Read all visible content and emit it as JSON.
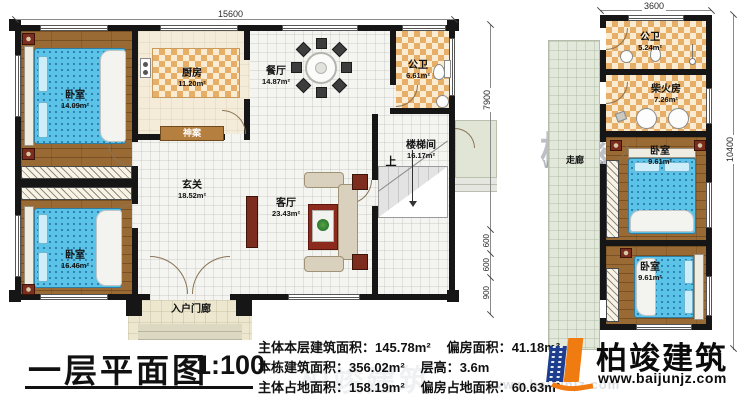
{
  "title": {
    "text": "一层平面图",
    "scale": "1:100"
  },
  "stats": [
    {
      "label1": "主体本层建筑面积：",
      "value1": "145.78m²",
      "label2": "偏房面积：",
      "value2": "41.18m²"
    },
    {
      "label1": "本栋建筑面积：",
      "value1": "356.02m²",
      "label2": "层高：",
      "value2": "3.6m"
    },
    {
      "label1": "主体占地面积：",
      "value1": "158.19m²",
      "label2": "偏房占地面积：",
      "value2": "60.63m²"
    }
  ],
  "logo": {
    "name": "柏竣建筑",
    "url": "www.baijunjz.com"
  },
  "watermark": {
    "name": "柏竣建筑",
    "url": "www.baijunjz.com"
  },
  "main_plan": {
    "dim_top": "15600",
    "dim_right": "7900",
    "dims_right_lower": [
      "600",
      "600",
      "900"
    ],
    "stairs_up": "上",
    "rooms": {
      "bedroom1": {
        "name": "卧室",
        "area": "14.09m²"
      },
      "bedroom2": {
        "name": "卧室",
        "area": "16.46m²"
      },
      "kitchen": {
        "name": "厨房",
        "area": "11.20m²"
      },
      "dining": {
        "name": "餐厅",
        "area": "14.87m²"
      },
      "bath": {
        "name": "公卫",
        "area": "6.61m²"
      },
      "stairwell": {
        "name": "楼梯间",
        "area": "16.17m²"
      },
      "hall": {
        "name": "玄关",
        "area": "18.52m²"
      },
      "living": {
        "name": "客厅",
        "area": "23.43m²"
      },
      "altar": {
        "name": "神案"
      },
      "porch": {
        "name": "入户门廊"
      }
    }
  },
  "annex_plan": {
    "dim_top": "3600",
    "dim_right": "10400",
    "rooms": {
      "bath": {
        "name": "公卫",
        "area": "5.24m²"
      },
      "firewood_kitchen": {
        "name": "柴火房",
        "area": "7.26m²"
      },
      "corridor": {
        "name": "走廊"
      },
      "bedroom_upper": {
        "name": "卧室",
        "area": "9.61m²"
      },
      "bedroom_lower": {
        "name": "卧室",
        "area": "9.61m²"
      }
    }
  },
  "colors": {
    "accent_blue": "#1d3e8e",
    "accent_orange": "#f07b10",
    "wall": "#161616",
    "bed": "#5cc3e8"
  }
}
